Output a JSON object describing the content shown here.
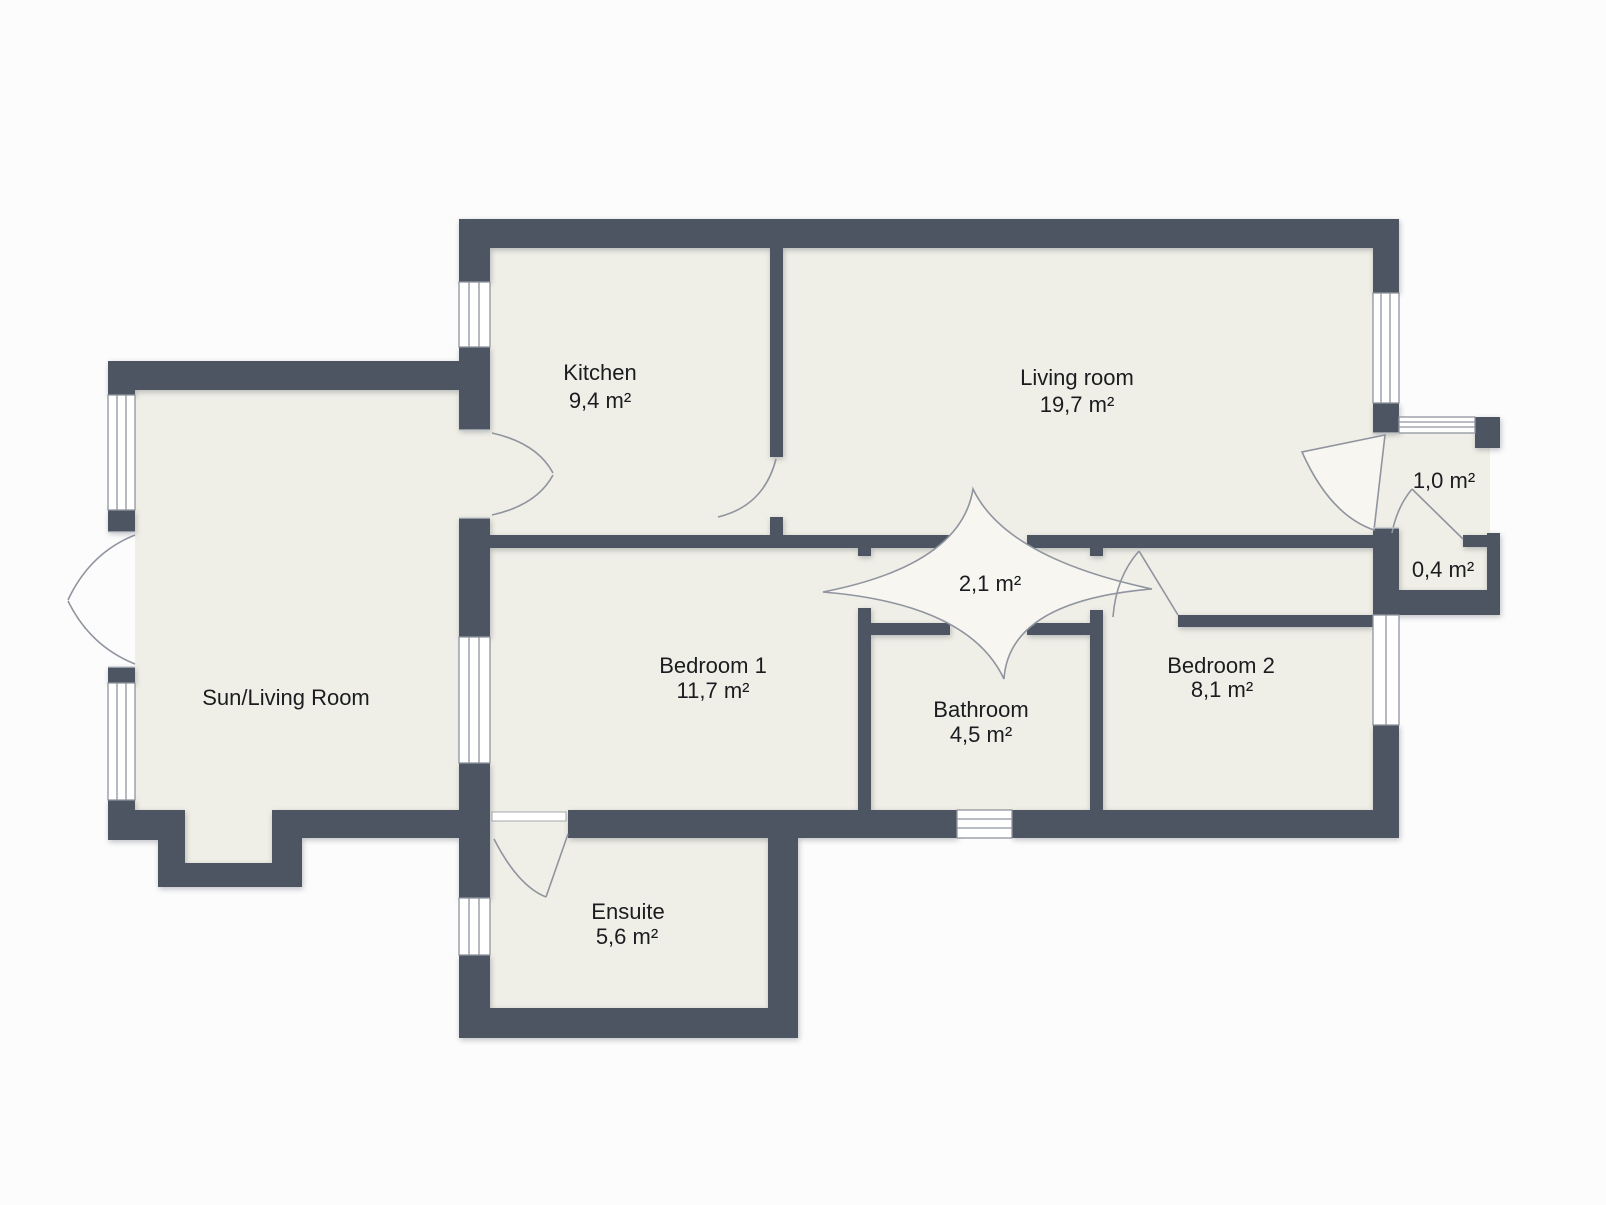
{
  "title": "Apartment floor plan",
  "palette": {
    "wall": "#4d5563",
    "floor": "#f0efe7",
    "door_fill": "#f7f6f1",
    "outline": "#8f949e",
    "window": "#ffffff",
    "text": "#1a1c20",
    "background": "#fcfcfc"
  },
  "rooms": [
    {
      "id": "kitchen",
      "name": "Kitchen",
      "area": "9,4 m²"
    },
    {
      "id": "living-room",
      "name": "Living room",
      "area": "19,7 m²"
    },
    {
      "id": "sun-living-room",
      "name": "Sun/Living Room",
      "area": ""
    },
    {
      "id": "bedroom-1",
      "name": "Bedroom 1",
      "area": "11,7 m²"
    },
    {
      "id": "hallway",
      "name": "",
      "area": "2,1 m²"
    },
    {
      "id": "bathroom",
      "name": "Bathroom",
      "area": "4,5 m²"
    },
    {
      "id": "bedroom-2",
      "name": "Bedroom 2",
      "area": "8,1 m²"
    },
    {
      "id": "entry",
      "name": "",
      "area": "1,0 m²"
    },
    {
      "id": "closet",
      "name": "",
      "area": "0,4 m²"
    }
  ],
  "rooms_extra": [
    {
      "id": "ensuite",
      "name": "Ensuite",
      "area": "5,6 m²"
    }
  ]
}
